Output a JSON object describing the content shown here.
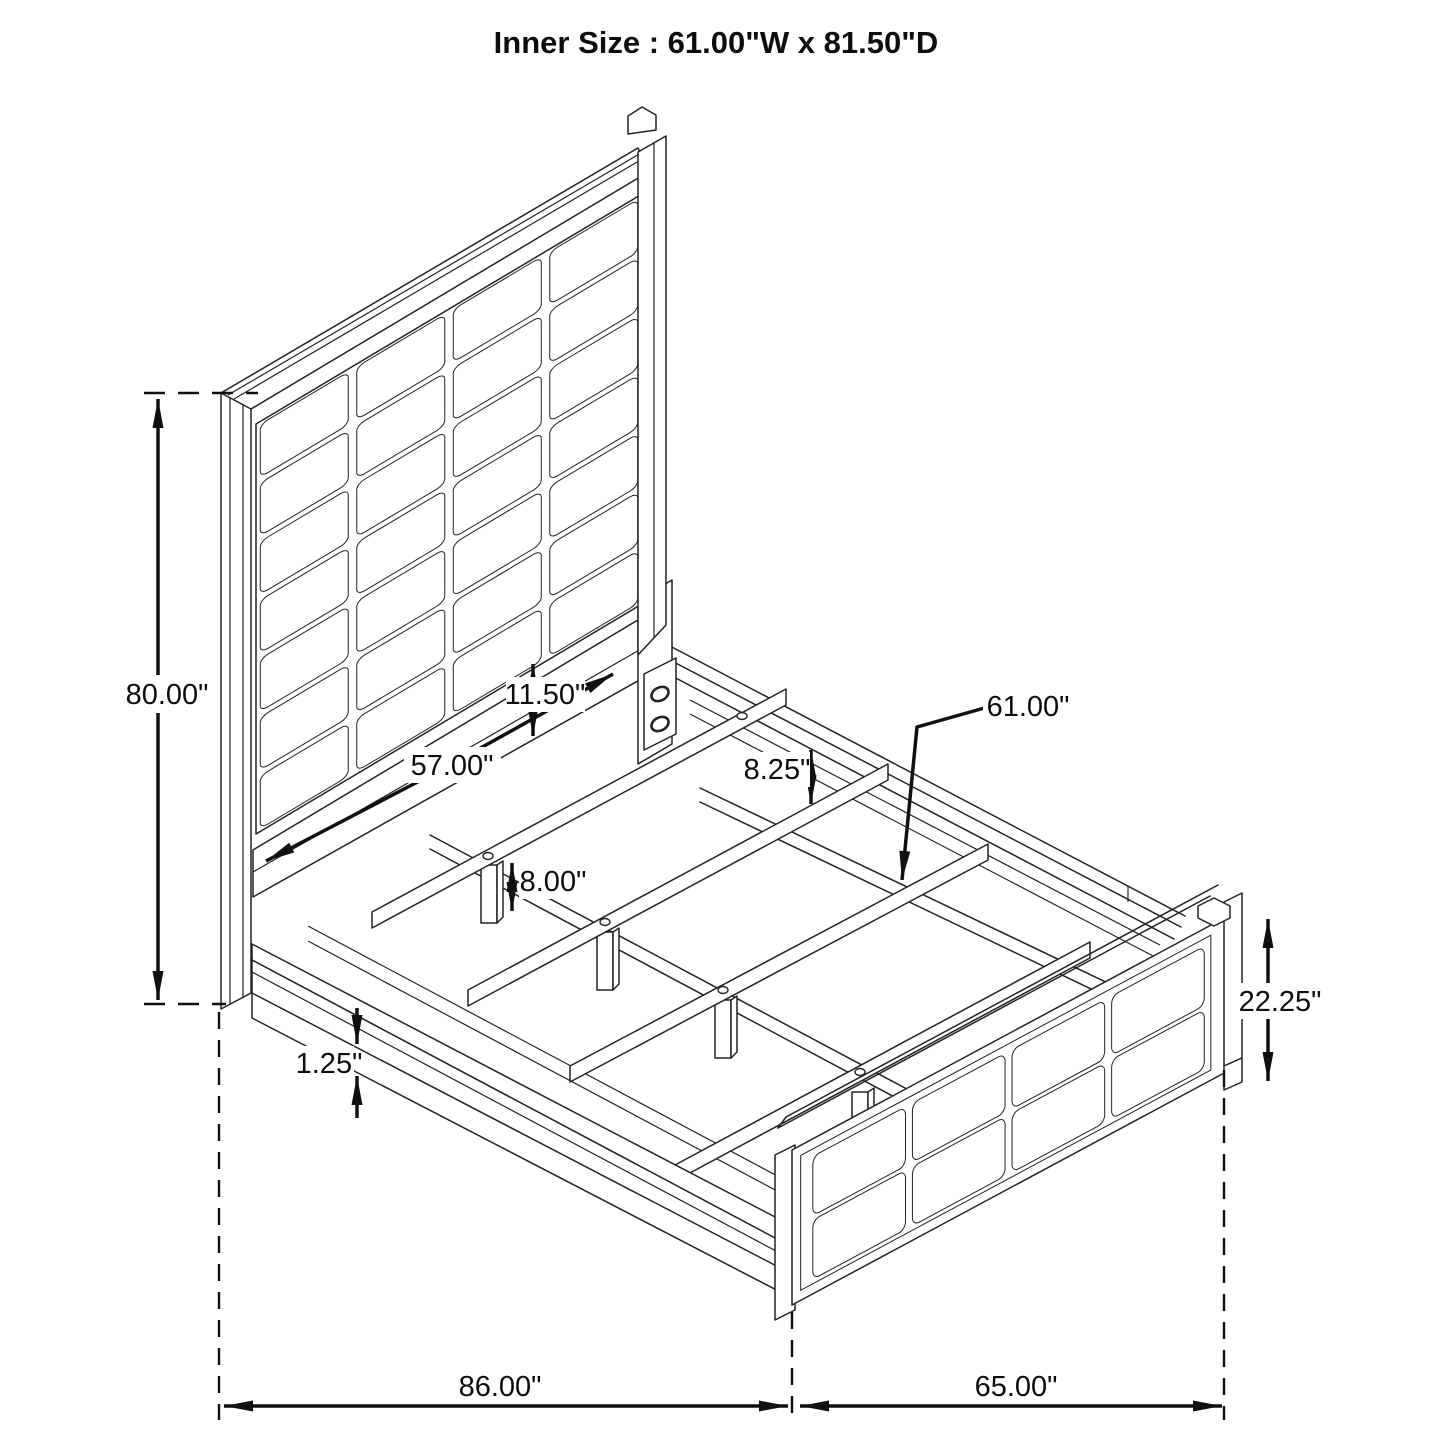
{
  "title": "Inner Size : 61.00\"W x 81.50\"D",
  "dimensions": {
    "headboard_height": "80.00\"",
    "panel_to_rail_gap": "11.50\"",
    "headboard_inner_width": "57.00\"",
    "rail_to_slat": "8.25\"",
    "slat_length": "61.00\"",
    "leg_height": "8.00\"",
    "base_trim": "1.25\"",
    "footboard_height": "22.25\"",
    "overall_length": "86.00\"",
    "overall_width": "65.00\""
  }
}
